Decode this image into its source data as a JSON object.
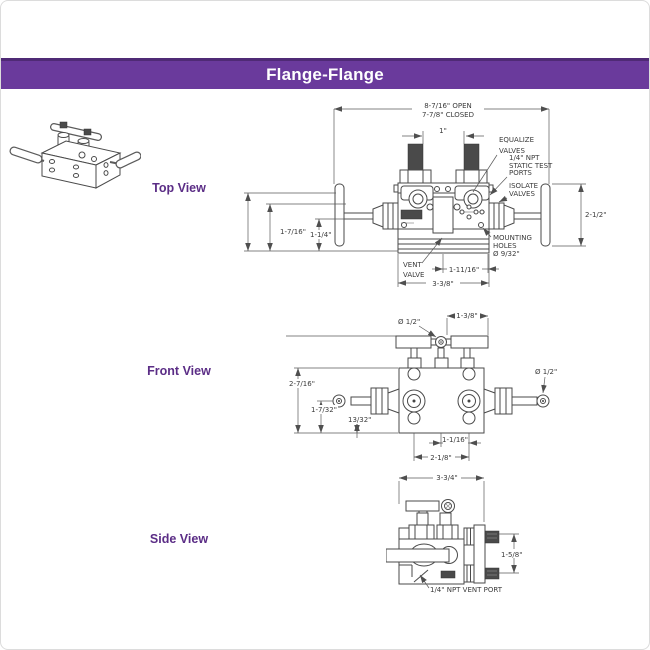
{
  "page": {
    "title": "Flange-Flange",
    "header_bg": "#6a3a9c",
    "view_label_color": "#5b2d86"
  },
  "views": {
    "top": {
      "label": "Top View",
      "ann": {
        "dim_open": "8-7/16\" OPEN",
        "dim_closed": "7-7/8\" CLOSED",
        "dim_stem": "1\"",
        "equalize1": "EQUALIZE",
        "equalize2": "VALVES",
        "static1": "1/4\" NPT",
        "static2": "STATIC TEST",
        "static3": "PORTS",
        "isolate1": "ISOLATE",
        "isolate2": "VALVES",
        "dim_handle": "2-1/2\"",
        "dim_left_outer": "1-7/16\"",
        "dim_left_inner": "1-1/4\"",
        "vent1": "VENT",
        "vent2": "VALVE",
        "mount1": "MOUNTING",
        "mount2": "HOLES",
        "mount3": "Ø 9/32\"",
        "dim_ports": "1-11/16\"",
        "dim_width": "3-3/8\""
      }
    },
    "front": {
      "label": "Front View",
      "ann": {
        "dia_top": "Ø 1/2\"",
        "dim_top": "1-3/8\"",
        "dia_side": "Ø 1/2\"",
        "dim_height": "2-7/16\"",
        "dim_center": "1-7/32\"",
        "dim_offset": "13/32\"",
        "dim_ports": "1-1/16\"",
        "dim_flange": "2-1/8\""
      }
    },
    "side": {
      "label": "Side View",
      "ann": {
        "dim_width": "3-3/4\"",
        "dim_height": "1-5/8\"",
        "vent_port": "1/4\" NPT VENT PORT"
      }
    }
  }
}
